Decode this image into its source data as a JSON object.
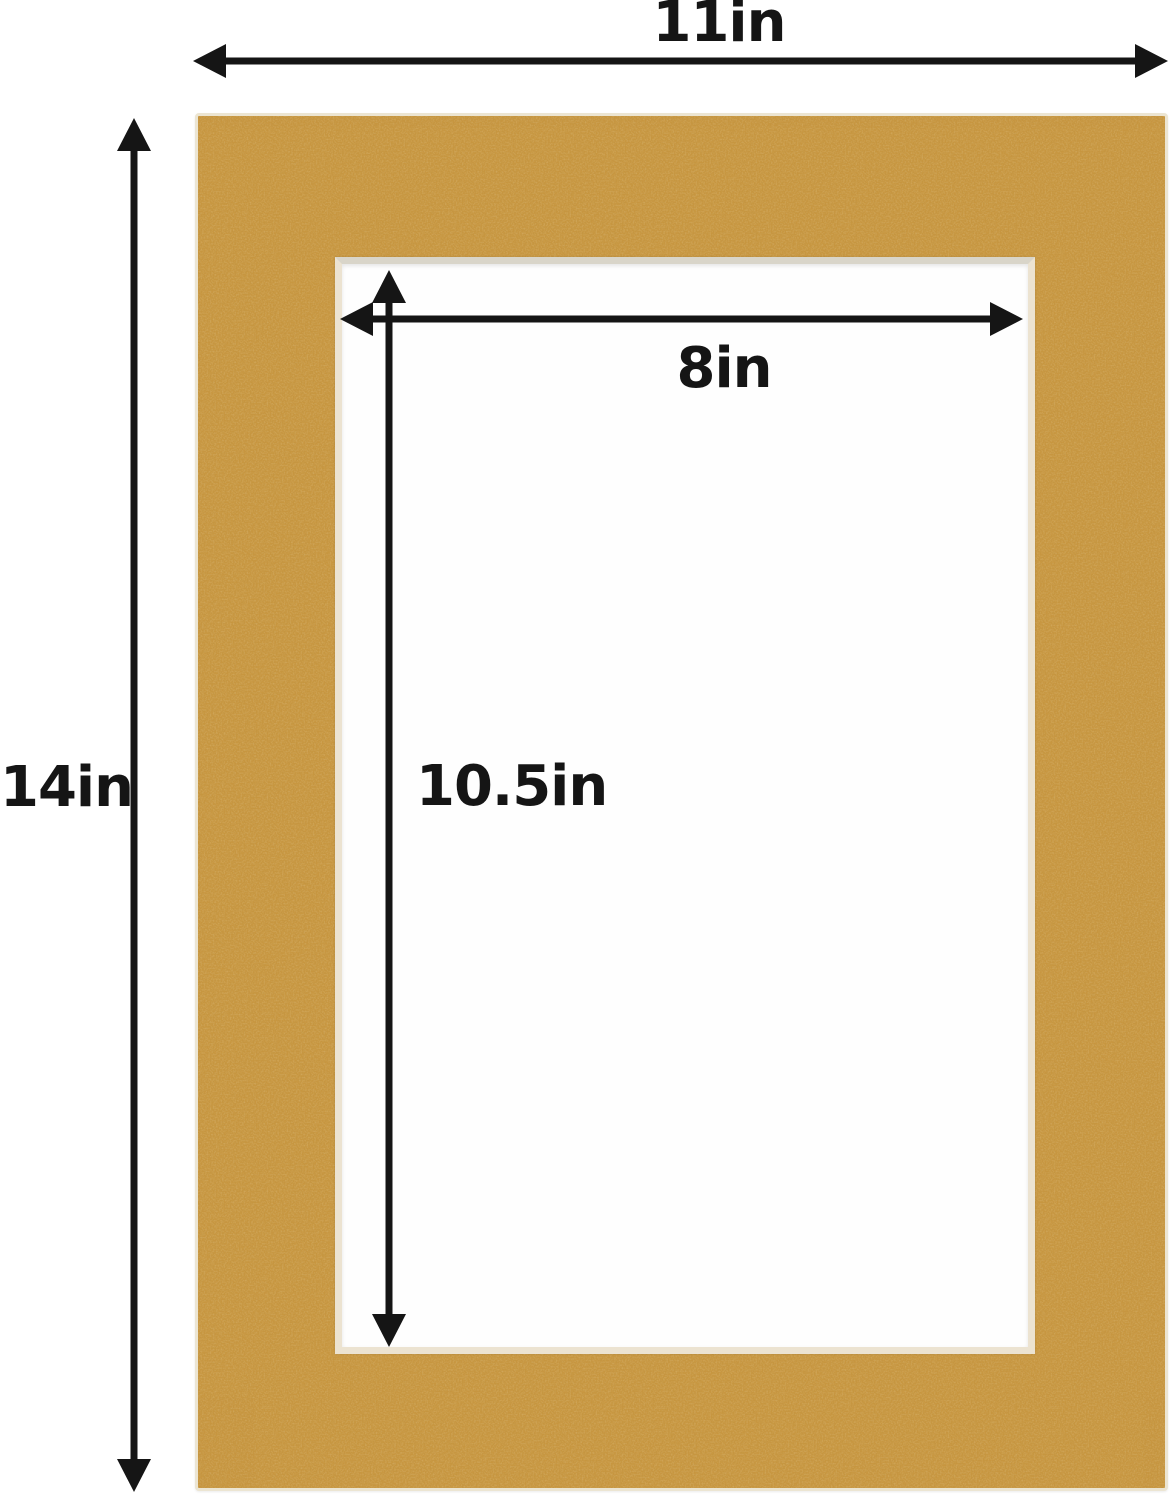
{
  "diagram": {
    "description": "Picture frame mat board with dimension annotations",
    "outer_width_label": "11in",
    "outer_height_label": "14in",
    "opening_width_label": "8in",
    "opening_height_label": "10.5in"
  },
  "colors": {
    "mat_board": "#c8963f",
    "mat_edge": "#ece5d2",
    "opening_bevel": "#ece3d1",
    "opening_fill": "#fefefe",
    "arrow": "#151515",
    "background": "#ffffff"
  }
}
